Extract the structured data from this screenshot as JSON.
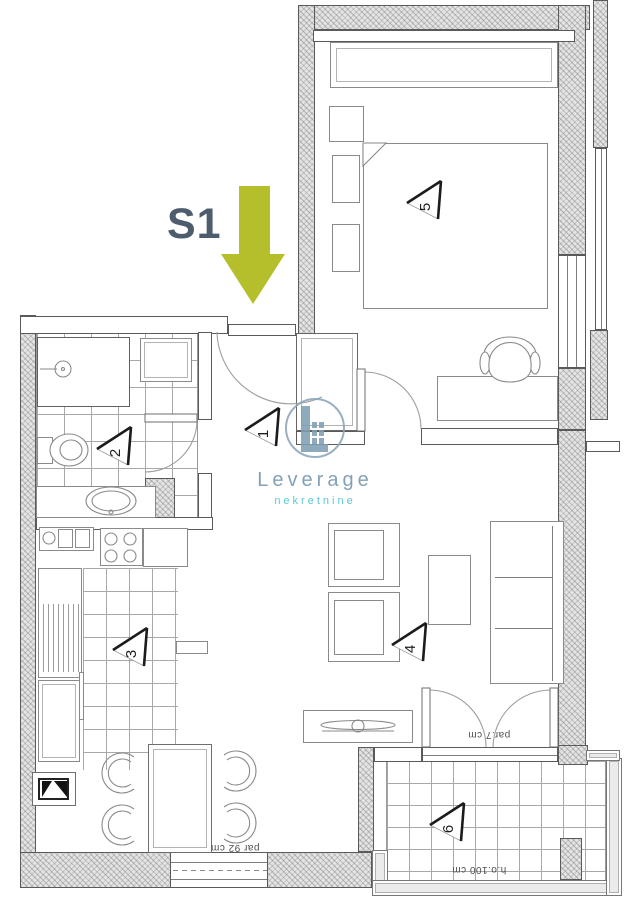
{
  "unit": {
    "label": "S1",
    "label_color": "#4d5d6d"
  },
  "entrance_arrow": {
    "direction": "down",
    "color": "#b5bf2c"
  },
  "brand": {
    "name": "Leverage",
    "tagline": "nekretnine",
    "name_color": "#7295ad",
    "tagline_color": "#43c2cc",
    "icon": "building-in-circle-icon"
  },
  "rooms": [
    {
      "number": "1"
    },
    {
      "number": "2"
    },
    {
      "number": "3"
    },
    {
      "number": "4"
    },
    {
      "number": "5"
    },
    {
      "number": "6"
    }
  ],
  "annotations": {
    "dining_window": "par 92 cm",
    "terrace_door": "par.7 cm",
    "terrace_railing": "h.o.100 cm"
  },
  "colors": {
    "wall_hatch": "#e4e4e4",
    "wall_line": "#5a5a5a",
    "tile_line": "#a8a8a8",
    "fixture_line": "#8a8a8a",
    "marker_bold": "#1c1c1c"
  }
}
